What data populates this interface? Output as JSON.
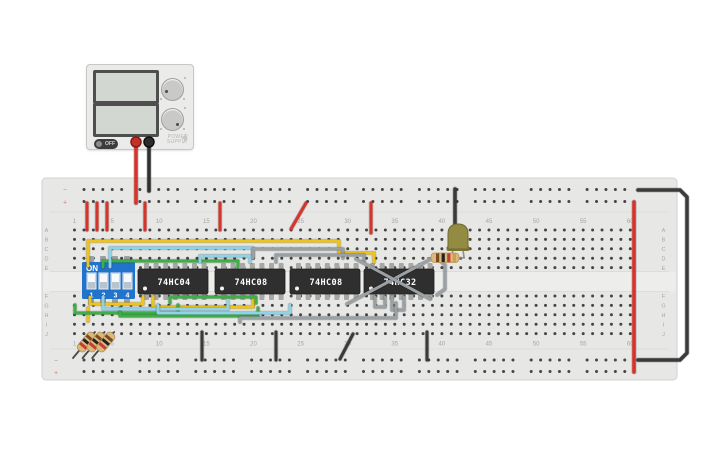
{
  "canvas": {
    "background": "#ffffff"
  },
  "power_supply": {
    "brand_line1": "POWER",
    "brand_line2": "SUPPLY",
    "off_label": "OFF",
    "body_color": "#ebebe9",
    "terminal_colors": {
      "positive": "#c62f28",
      "negative": "#2c2c2c"
    }
  },
  "breadboard": {
    "column_labels": [
      "1",
      "5",
      "10",
      "15",
      "20",
      "25",
      "30",
      "35",
      "40",
      "45",
      "50",
      "55",
      "60"
    ],
    "row_labels": [
      "A",
      "B",
      "C",
      "D",
      "E",
      "F",
      "G",
      "H",
      "I",
      "J"
    ],
    "rail_labels": {
      "minus": "−",
      "plus": "+"
    },
    "body_color": "#e7e7e5"
  },
  "components": {
    "dip_switch": {
      "title": "ON",
      "pin_labels": [
        "1",
        "2",
        "3",
        "4"
      ],
      "body_color": "#2173cc"
    },
    "ics": [
      {
        "label": "74HC04"
      },
      {
        "label": "74HC08"
      },
      {
        "label": "74HC08"
      },
      {
        "label": "74HC32"
      }
    ],
    "led": {
      "body_color": "#938b42"
    },
    "resistor_horizontal": {
      "body_color": "#d9b97c",
      "bands": [
        "#7c4a1e",
        "#222222",
        "#cc3b30",
        "#c9a14c"
      ]
    },
    "resistors_diagonal": {
      "count": 3,
      "body_color": "#d9b97c",
      "bands": [
        "#7c4a1e",
        "#222222",
        "#cc3b30"
      ]
    }
  },
  "wires": [
    {
      "name": "psu-red-lead",
      "color": "#d8332b",
      "w": 3.5,
      "points": [
        [
          136,
          142
        ],
        [
          136,
          203
        ]
      ]
    },
    {
      "name": "psu-black-lead",
      "color": "#2f2f2f",
      "w": 3.5,
      "points": [
        [
          149,
          142
        ],
        [
          149,
          191
        ]
      ]
    },
    {
      "name": "red-jumper-a",
      "color": "#d8332b",
      "w": 3,
      "points": [
        [
          87,
          203
        ],
        [
          87,
          230
        ]
      ]
    },
    {
      "name": "red-jumper-b",
      "color": "#d8332b",
      "w": 3,
      "points": [
        [
          97,
          203
        ],
        [
          97,
          230
        ]
      ]
    },
    {
      "name": "red-jumper-c",
      "color": "#d8332b",
      "w": 3,
      "points": [
        [
          107,
          203
        ],
        [
          107,
          230
        ]
      ]
    },
    {
      "name": "red-jumper-d",
      "color": "#d8332b",
      "w": 3,
      "points": [
        [
          145,
          203
        ],
        [
          145,
          230
        ]
      ]
    },
    {
      "name": "red-jumper-e",
      "color": "#d8332b",
      "w": 3,
      "points": [
        [
          220,
          203
        ],
        [
          220,
          230
        ]
      ]
    },
    {
      "name": "red-jumper-f",
      "color": "#d8332b",
      "w": 3,
      "points": [
        [
          306,
          203
        ],
        [
          291,
          229
        ]
      ]
    },
    {
      "name": "red-jumper-g",
      "color": "#d8332b",
      "w": 3,
      "points": [
        [
          371,
          203
        ],
        [
          371,
          233
        ]
      ]
    },
    {
      "name": "red-rail-link",
      "color": "#d8332b",
      "w": 3.5,
      "points": [
        [
          634,
          202
        ],
        [
          634,
          372
        ]
      ]
    },
    {
      "name": "black-rail-link",
      "color": "#3a3a3a",
      "w": 3.5,
      "points": [
        [
          638,
          190
        ],
        [
          680,
          190
        ],
        [
          687,
          197
        ],
        [
          687,
          353
        ],
        [
          680,
          360
        ],
        [
          638,
          360
        ]
      ]
    },
    {
      "name": "led-ground-wire",
      "color": "#3a3a3a",
      "w": 3.5,
      "points": [
        [
          455,
          189
        ],
        [
          455,
          226
        ]
      ]
    },
    {
      "name": "black-jumper-a",
      "color": "#3a3a3a",
      "w": 3,
      "points": [
        [
          202,
          332
        ],
        [
          202,
          360
        ]
      ]
    },
    {
      "name": "black-jumper-b",
      "color": "#3a3a3a",
      "w": 3,
      "points": [
        [
          276,
          332
        ],
        [
          276,
          360
        ]
      ]
    },
    {
      "name": "black-jumper-c",
      "color": "#3a3a3a",
      "w": 3,
      "points": [
        [
          353,
          334
        ],
        [
          340,
          359
        ]
      ]
    },
    {
      "name": "black-jumper-d",
      "color": "#3a3a3a",
      "w": 3,
      "points": [
        [
          427,
          332
        ],
        [
          427,
          360
        ]
      ]
    },
    {
      "name": "yellow-wire-a",
      "color": "#eec31b",
      "w": 3,
      "points": [
        [
          88,
          266
        ],
        [
          88,
          241
        ],
        [
          339,
          241
        ],
        [
          339,
          253
        ],
        [
          374,
          253
        ],
        [
          374,
          262
        ]
      ]
    },
    {
      "name": "yellow-wire-b",
      "color": "#eec31b",
      "w": 3,
      "points": [
        [
          90,
          297
        ],
        [
          90,
          304
        ],
        [
          143,
          304
        ],
        [
          143,
          297
        ]
      ]
    },
    {
      "name": "yellow-wire-c",
      "color": "#eec31b",
      "w": 3,
      "points": [
        [
          153,
          297
        ],
        [
          153,
          307
        ],
        [
          253,
          307
        ],
        [
          253,
          299
        ]
      ]
    },
    {
      "name": "yellow-wire-d",
      "color": "#eec31b",
      "w": 3,
      "points": [
        [
          88,
          308
        ],
        [
          88,
          321
        ]
      ]
    },
    {
      "name": "green-wire-a",
      "color": "#3fae49",
      "w": 3,
      "points": [
        [
          103,
          267
        ],
        [
          103,
          261
        ],
        [
          238,
          261
        ],
        [
          238,
          267
        ]
      ]
    },
    {
      "name": "green-wire-b",
      "color": "#3fae49",
      "w": 3,
      "points": [
        [
          170,
          303
        ],
        [
          170,
          297
        ],
        [
          256,
          297
        ],
        [
          256,
          303
        ]
      ]
    },
    {
      "name": "green-wire-c",
      "color": "#3fae49",
      "w": 3,
      "points": [
        [
          75,
          305
        ],
        [
          75,
          313
        ],
        [
          178,
          313
        ],
        [
          178,
          305
        ]
      ]
    },
    {
      "name": "green-wire-d",
      "color": "#3fae49",
      "w": 3,
      "points": [
        [
          120,
          308
        ],
        [
          120,
          316
        ],
        [
          258,
          316
        ],
        [
          258,
          308
        ]
      ]
    },
    {
      "name": "cyan-wire-a",
      "color": "#8ed4e6",
      "w": 3,
      "points": [
        [
          110,
          267
        ],
        [
          110,
          248
        ],
        [
          253,
          248
        ],
        [
          253,
          258
        ]
      ]
    },
    {
      "name": "cyan-wire-b",
      "color": "#8ed4e6",
      "w": 3,
      "points": [
        [
          200,
          262
        ],
        [
          200,
          256
        ],
        [
          250,
          256
        ],
        [
          250,
          262
        ]
      ]
    },
    {
      "name": "cyan-wire-c",
      "color": "#8ed4e6",
      "w": 3,
      "points": [
        [
          103,
          297
        ],
        [
          103,
          309
        ],
        [
          228,
          309
        ],
        [
          228,
          300
        ]
      ]
    },
    {
      "name": "cyan-wire-d",
      "color": "#8ed4e6",
      "w": 3,
      "points": [
        [
          158,
          305
        ],
        [
          158,
          313
        ],
        [
          290,
          313
        ],
        [
          290,
          305
        ]
      ]
    },
    {
      "name": "gray-wire-a",
      "color": "#9aa0a3",
      "w": 3,
      "points": [
        [
          253,
          258
        ],
        [
          253,
          249
        ],
        [
          343,
          249
        ],
        [
          343,
          258
        ]
      ]
    },
    {
      "name": "gray-wire-b",
      "color": "#9aa0a3",
      "w": 3,
      "points": [
        [
          276,
          262
        ],
        [
          276,
          255
        ],
        [
          364,
          255
        ],
        [
          364,
          262
        ]
      ]
    },
    {
      "name": "gray-wire-c",
      "color": "#9aa0a3",
      "w": 3,
      "points": [
        [
          347,
          304
        ],
        [
          433,
          258
        ]
      ]
    },
    {
      "name": "gray-wire-d",
      "color": "#9aa0a3",
      "w": 3,
      "points": [
        [
          356,
          259
        ],
        [
          430,
          299
        ]
      ]
    },
    {
      "name": "gray-wire-e",
      "color": "#9aa0a3",
      "w": 3,
      "points": [
        [
          375,
          297
        ],
        [
          375,
          307
        ],
        [
          385,
          307
        ],
        [
          385,
          297
        ]
      ]
    },
    {
      "name": "gray-wire-f",
      "color": "#9aa0a3",
      "w": 3,
      "points": [
        [
          392,
          297
        ],
        [
          392,
          310
        ],
        [
          404,
          310
        ],
        [
          404,
          297
        ]
      ]
    },
    {
      "name": "gray-wire-g",
      "color": "#9aa0a3",
      "w": 3,
      "points": [
        [
          240,
          322
        ],
        [
          240,
          318
        ],
        [
          396,
          318
        ],
        [
          396,
          303
        ]
      ]
    },
    {
      "name": "gray-wire-h",
      "color": "#9aa0a3",
      "w": 3,
      "points": [
        [
          437,
          258
        ],
        [
          445,
          265
        ],
        [
          445,
          289
        ],
        [
          437,
          295
        ]
      ]
    }
  ]
}
